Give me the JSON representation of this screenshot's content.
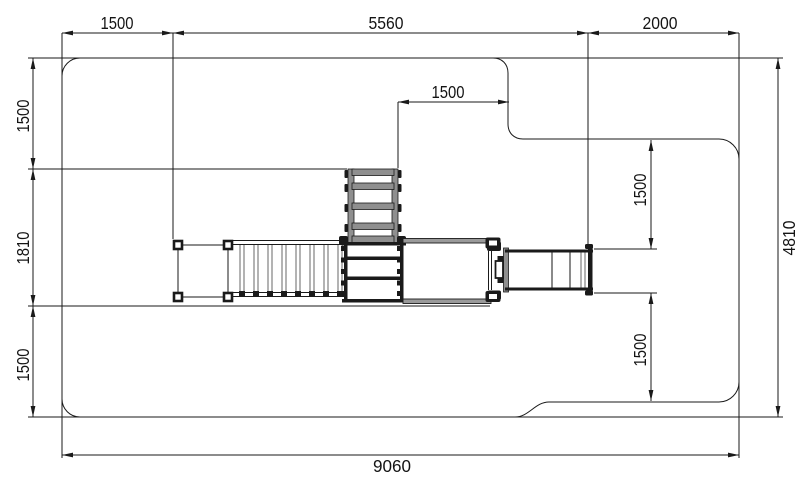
{
  "dimensions": {
    "top_left": "1500",
    "top_middle": "5560",
    "top_right": "2000",
    "left_upper": "1500",
    "left_middle": "1810",
    "left_lower": "1500",
    "right_overall": "4810",
    "notch": "1500",
    "right_upper": "1500",
    "right_lower": "1500",
    "bottom_overall": "9060"
  },
  "colors": {
    "line": "#1a1a1a",
    "equipment_gray": "#8f8f8f",
    "deck_gray": "#9a9a9a",
    "background": "#ffffff"
  }
}
